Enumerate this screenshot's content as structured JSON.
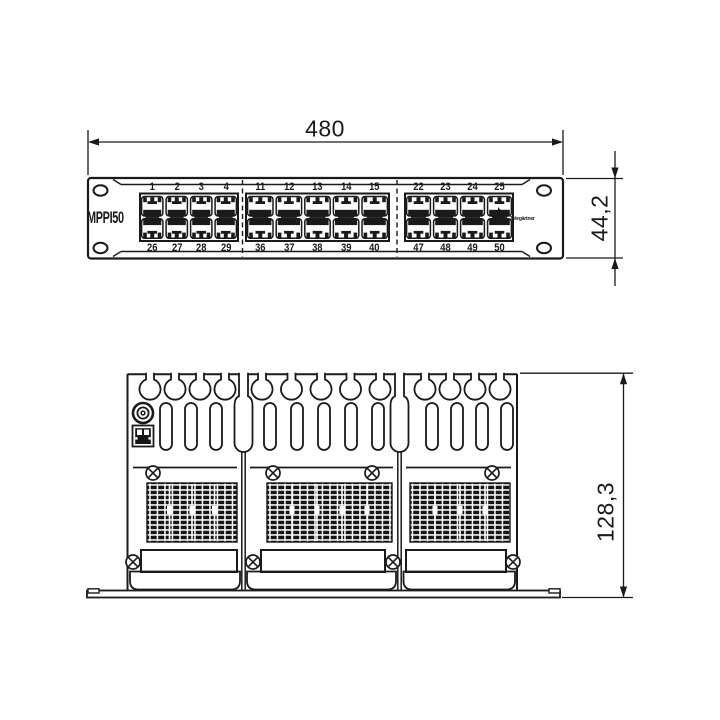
{
  "colors": {
    "line": "#1a1a1a",
    "background": "#ffffff"
  },
  "dimensions": {
    "width": "480",
    "front_height": "44,2",
    "depth": "128,3"
  },
  "front_view": {
    "panel_label": "MPPI50",
    "brand": {
      "logo_icon": "four-pointed-star-icon",
      "name": "Telegärtner"
    },
    "mounting_holes_per_ear": 2,
    "port_groups": [
      {
        "top": [
          "1",
          "2",
          "3",
          "4"
        ],
        "bottom": [
          "26",
          "27",
          "28",
          "29"
        ]
      },
      {
        "top": [
          "11",
          "12",
          "13",
          "14",
          "15"
        ],
        "bottom": [
          "36",
          "37",
          "38",
          "39",
          "40"
        ]
      },
      {
        "top": [
          "22",
          "23",
          "24",
          "25"
        ],
        "bottom": [
          "47",
          "48",
          "49",
          "50"
        ]
      }
    ]
  },
  "rear_view": {
    "sections": [
      {
        "strain_relief_fingers": 4,
        "cable_slots": 3
      },
      {
        "strain_relief_fingers": 5,
        "cable_slots": 5
      },
      {
        "strain_relief_fingers": 4,
        "cable_slots": 4
      }
    ],
    "features": [
      "grounding-stud-icon",
      "shielded-jack-icon",
      "idc-termination-block",
      "label-window",
      "fixing-screw"
    ]
  }
}
